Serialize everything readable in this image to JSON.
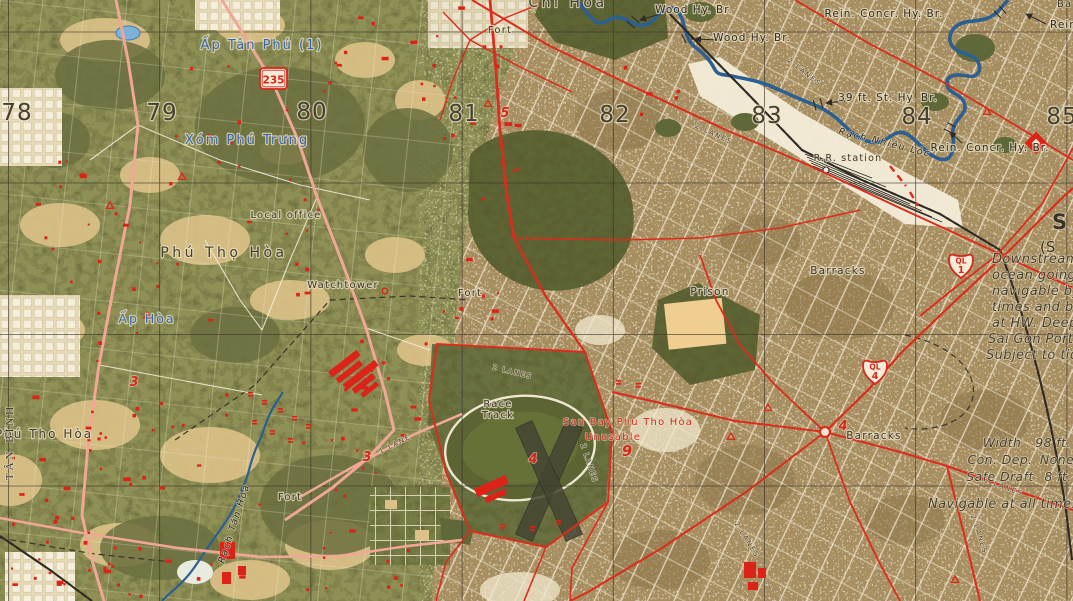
{
  "grid": {
    "n78": "78",
    "n79": "79",
    "n80": "80",
    "n81": "81",
    "n82": "82",
    "n83": "83",
    "n84": "84",
    "n85": "85"
  },
  "places": {
    "chi_hoa": "Chí Hòa",
    "ap_tan_phu": "Ấp Tân Phú (1)",
    "xom_phu_trung": "Xóm Phú Trưng",
    "phu_tho_hoa_upper": "Phú Thọ Hòa",
    "ap_hoa": "Ấp Hòa",
    "phu_tho_hoa_lower": "Phú Tho Hòa",
    "tan_binh": "TÂN BÌNH",
    "saigon_s": "S",
    "saigon_s2": "(S",
    "ba_partial": "Ba"
  },
  "features": {
    "fort": "Fort",
    "local_office": "Local office",
    "watchtower": "Watchtower",
    "prison": "Prison",
    "barracks": "Barracks",
    "race_1": "Race",
    "race_2": "Track",
    "rr_station": "R.R. station",
    "airfield_name": "San Bay Phu Tho Hòa",
    "airfield_status": "Unusable"
  },
  "bridges": {
    "wood": "Wood Hy. Br.",
    "rein_concr": "Rein. Concr. Hy. Br.",
    "rein_partial": "Rein",
    "st39": "39 ft. St. Hy. Br."
  },
  "rivers": {
    "nhieu_loc": "Rạch Nhiêu Lộc",
    "tan_hoa": "Rạch Tân Hóa"
  },
  "routes": {
    "r235": "235",
    "ql": "QL",
    "n1": "1",
    "n4": "4",
    "two_lanes": "2 LANES",
    "one_lane": "1 LANE"
  },
  "route_markers": {
    "m3": "3",
    "m4": "4",
    "m5": "5",
    "m9": "9"
  },
  "annotations": {
    "downstream": [
      "Downstream f",
      "ocean going sh",
      "navigable by l",
      "times and by",
      "at HW.  Deepe",
      "Sai Gon Port",
      "Subject to tida"
    ],
    "table": {
      "w_l": "Width",
      "w_v": "98 ft.",
      "c_l": "Con. Dep.",
      "c_v": "None",
      "s_l": "Safe Draft",
      "s_v": "8 ft."
    },
    "navigable": "Navigable at all times by L"
  },
  "colors": {
    "paper": "#e9dfc0",
    "veg_green": "#8e9054",
    "forest": "#5d6534",
    "urban_tan": "#a78e61",
    "road_red": "#dd2b1c",
    "river_blue": "#3f7cb6",
    "label_blue": "#3a65ad",
    "rail_black": "#2e2a24"
  }
}
